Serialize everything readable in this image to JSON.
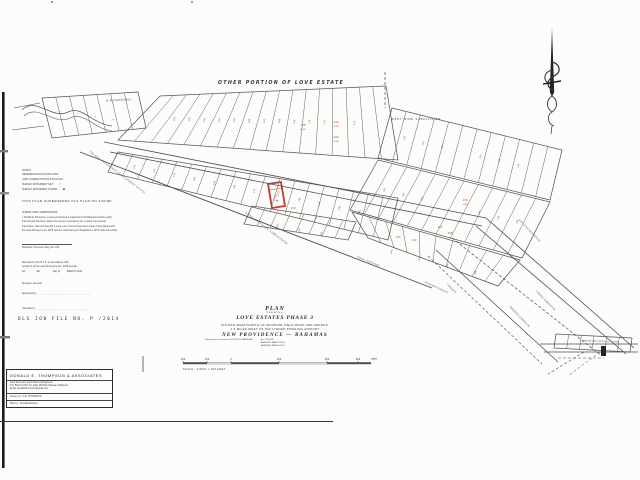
{
  "notes": {
    "title": "NOTES",
    "line1": "REFERENCE DLS PLANS NOS.",
    "line2": "GRID CONNECTION DLS PLAN NO.",
    "line3": "SURVEY MONUMENT SET",
    "line4": "SURVEY MONUMENT FOUND",
    "symbol_set": "○",
    "symbol_found": "■",
    "supersedes": "THIS PLAN SUPERSEDES DLS PLAN NO.532/NP"
  },
  "certificate": {
    "title": "SURVEYOR'S CERTIFICATE",
    "body": [
      "I, Donald E. Thompson, a surveyor licensed & registered in the Bahamas hereby certify",
      "that this plan has been made from surveys executed by me or under my personal",
      "supervision, that both the plan & survey are correct & have been made in accordance with",
      "the Land Surveyor's Act, 1975, and the Land Surveyor's Regulations, 1975 made thereunder."
    ],
    "signature": "Donald E. Thompson  Reg. No. 035"
  },
  "recorded": {
    "line1": "Recorded in the D.L.S. in accordance with",
    "line2": "section 6 of the Land Surveyors Act, 1975 as plan",
    "no": "No.",
    "day": "9th",
    "of": "Day of",
    "date": "MARCH 2014"
  },
  "admin": {
    "surveyor_general": "Surveyor General",
    "approved": "Approved by",
    "checked": "Checked by",
    "dots": "_ _ _ _ _ _ _ _ _ _ _ _ _ _ _",
    "dls_job": "DLS JOB FILE NO. P  /2014"
  },
  "title_block": {
    "plan": "PLAN",
    "shewing": "SHEWING",
    "name": "LOVE ESTATES PHASE 3",
    "situate1": "SITUATE WEST/NORTH OF WINDSOR FIELD ROAD AND APPROX.",
    "situate2": "1.5 MILES WEST OF SIR LYNDEN PINDLING AIRPORT",
    "location": "NEW PROVIDENCE  —  BAHAMAS",
    "instance": "Surveyed at the instance of DOTSON & MARSHALL",
    "acc": "Acc: 236,398",
    "amended1": "AMENDED MARCH 2014",
    "amended2": "AMENDED MARCH 2014"
  },
  "scale_bar": {
    "ticks": [
      {
        "t": "200",
        "x": 183
      },
      {
        "t": "100",
        "x": 207
      },
      {
        "t": "0",
        "x": 231
      },
      {
        "t": "200",
        "x": 279
      },
      {
        "t": "400",
        "x": 327
      },
      {
        "t": "600",
        "x": 358
      }
    ],
    "feet": "FEET",
    "feet_x": 374,
    "label": "SCALE : 1INCH = 200 FEET"
  },
  "firm_box": {
    "name": "DONALD E. THOMPSON & ASSOCIATES",
    "line1": "Land Surveyors-Land Planners-Engineers",
    "line2": "P.O. BOX N-1817  Tel. (242) 356-5014  Nassau, Bahamas",
    "line3": "Email: donaldethompson@gmail.com",
    "survey_by": "Survey by : D.E. THOMPSON",
    "plan_by": "Plan by : Kendall Mortimer"
  },
  "plan": {
    "red_color": "#bf3a32",
    "ink_color": "#454545",
    "svg_labels": [
      {
        "t": "OTHER PORTION OF LOVE ESTATE",
        "x": 281,
        "y": 84,
        "s": 4.8,
        "c": "#3a3a3a",
        "f": "si",
        "ls": 1.3,
        "n": "other-portion-label"
      },
      {
        "t": "WEST WIND SUBDIVISION",
        "x": 416,
        "y": 120,
        "s": 2.9,
        "c": "#4a4a4a",
        "ls": 0.6,
        "n": "west-wind-label"
      },
      {
        "t": "H.B.HANCHELL",
        "x": 119,
        "y": 101,
        "r": -3,
        "s": 2.9,
        "c": "#4a4a4a",
        "ls": 0.4,
        "n": "hanchell-label"
      },
      {
        "t": "THE NEW PROVIDENCE DEVELOPMENT CO.LTD.",
        "x": 117,
        "y": 173,
        "r": 37,
        "s": 2.5,
        "c": "#565656",
        "ls": 0.3,
        "n": "npd-boundary-label"
      },
      {
        "t": "CHARLOTTEVILLE SUBDIVISION",
        "x": 266,
        "y": 229,
        "r": 37,
        "s": 2.7,
        "c": "#565656",
        "ls": 0.4,
        "n": "charlotteville-label"
      },
      {
        "t": "60FT. ROAD RESERVATION",
        "x": 529,
        "y": 231,
        "r": 46,
        "s": 2.3,
        "c": "#636363",
        "n": "road-reservation-label"
      },
      {
        "t": "FOXDALE SUBDIVISION",
        "x": 545,
        "y": 301,
        "r": 46,
        "s": 2.3,
        "c": "#636363",
        "n": "foxdale-label"
      },
      {
        "t": "PINERIDGE SUBDIVISION",
        "x": 519,
        "y": 317,
        "r": 46,
        "s": 2.3,
        "c": "#636363",
        "n": "pineridge-label"
      },
      {
        "t": "TURNBERRY",
        "x": 451,
        "y": 289,
        "r": 46,
        "s": 2.1,
        "c": "#6a6a6a",
        "n": "turnberry-label"
      },
      {
        "t": "FOXHILL SUBDIVISION",
        "x": 368,
        "y": 262,
        "r": 22,
        "s": 2.2,
        "c": "#636363",
        "n": "foxhill-label"
      },
      {
        "t": "PERMANENT TERRACES",
        "x": 436,
        "y": 288,
        "r": 25,
        "s": 2.2,
        "c": "#636363",
        "n": "terraces-label"
      },
      {
        "t": "WINDSOR FIELD ROAD (60FT. WIDE)",
        "x": 600,
        "y": 342,
        "r": 2,
        "s": 2.1,
        "c": "#565656",
        "n": "windsor-field-road-label"
      },
      {
        "t": "173",
        "x": 279,
        "y": 194,
        "r": -80,
        "s": 2.9,
        "c": "#bf3a32",
        "n": "red-lot-number"
      },
      {
        "t": "9,583",
        "x": 275.5,
        "y": 198,
        "r": -80,
        "s": 2,
        "c": "#bf3a32",
        "n": "red-lot-area"
      },
      {
        "t": "118",
        "x": 303,
        "y": 126,
        "s": 2.8,
        "c": "#bf3a32",
        "n": "red-lot-number"
      },
      {
        "t": "5,000",
        "x": 303,
        "y": 130,
        "s": 1.9,
        "c": "#bf3a32",
        "n": "red-lot-area"
      },
      {
        "t": "119",
        "x": 336,
        "y": 123,
        "s": 2.8,
        "c": "#bf3a32",
        "n": "red-lot-number"
      },
      {
        "t": "5,000",
        "x": 336,
        "y": 127,
        "s": 1.9,
        "c": "#bf3a32",
        "n": "red-lot-area"
      },
      {
        "t": "120",
        "x": 336,
        "y": 138,
        "s": 2.8,
        "c": "#bf3a32",
        "n": "red-lot-number"
      },
      {
        "t": "5,000",
        "x": 336,
        "y": 142,
        "s": 1.9,
        "c": "#bf3a32",
        "n": "red-lot-area"
      },
      {
        "t": "139",
        "x": 293,
        "y": 209,
        "s": 2.6,
        "c": "#bf3a32",
        "n": "red-lot-number"
      },
      {
        "t": "143",
        "x": 398,
        "y": 238,
        "s": 2.6,
        "c": "#bf3a32",
        "n": "red-lot-number"
      },
      {
        "t": "144",
        "x": 414,
        "y": 241,
        "s": 2.6,
        "c": "#bf3a32",
        "n": "red-lot-number"
      },
      {
        "t": "156",
        "x": 465,
        "y": 201,
        "s": 2.8,
        "c": "#bf3a32",
        "n": "red-lot-number"
      },
      {
        "t": "5,000",
        "x": 465,
        "y": 205,
        "s": 1.9,
        "c": "#bf3a32",
        "n": "red-lot-area"
      },
      {
        "t": "157",
        "x": 440,
        "y": 228,
        "s": 2.8,
        "c": "#bf3a32",
        "n": "red-lot-number"
      },
      {
        "t": "158",
        "x": 450,
        "y": 234,
        "s": 2.8,
        "c": "#bf3a32",
        "n": "red-lot-number"
      },
      {
        "t": "101",
        "x": 175,
        "y": 119,
        "r": -80,
        "s": 2.1
      },
      {
        "t": "102",
        "x": 190,
        "y": 119,
        "r": -80,
        "s": 2.1
      },
      {
        "t": "103",
        "x": 205,
        "y": 120,
        "r": -80,
        "s": 2.1
      },
      {
        "t": "104",
        "x": 220,
        "y": 120,
        "r": -80,
        "s": 2.1
      },
      {
        "t": "105",
        "x": 235,
        "y": 120,
        "r": -80,
        "s": 2.1
      },
      {
        "t": "106",
        "x": 250,
        "y": 121,
        "r": -80,
        "s": 2.1
      },
      {
        "t": "107",
        "x": 265,
        "y": 121,
        "r": -80,
        "s": 2.1
      },
      {
        "t": "108",
        "x": 280,
        "y": 121,
        "r": -80,
        "s": 2.1
      },
      {
        "t": "109",
        "x": 295,
        "y": 122,
        "r": -80,
        "s": 2.1
      },
      {
        "t": "110",
        "x": 310,
        "y": 122,
        "r": -80,
        "s": 2.1
      },
      {
        "t": "111",
        "x": 325,
        "y": 122,
        "r": -80,
        "s": 2.1
      },
      {
        "t": "112",
        "x": 355,
        "y": 123,
        "r": -80,
        "s": 2.1
      },
      {
        "t": "121",
        "x": 405,
        "y": 138,
        "r": -75,
        "s": 2.1
      },
      {
        "t": "122",
        "x": 424,
        "y": 143,
        "r": -75,
        "s": 2.1
      },
      {
        "t": "123",
        "x": 443,
        "y": 147,
        "r": -75,
        "s": 2.1
      },
      {
        "t": "124",
        "x": 481,
        "y": 157,
        "r": -75,
        "s": 2.1
      },
      {
        "t": "125",
        "x": 500,
        "y": 161,
        "r": -75,
        "s": 2.1
      },
      {
        "t": "126",
        "x": 519,
        "y": 166,
        "r": -75,
        "s": 2.1
      },
      {
        "t": "131",
        "x": 385,
        "y": 190,
        "r": -75,
        "s": 2.1
      },
      {
        "t": "132",
        "x": 404,
        "y": 195,
        "r": -75,
        "s": 2.1
      },
      {
        "t": "133",
        "x": 423,
        "y": 199,
        "r": -75,
        "s": 2.1
      },
      {
        "t": "134",
        "x": 480,
        "y": 213,
        "r": -75,
        "s": 2.1
      },
      {
        "t": "135",
        "x": 499,
        "y": 218,
        "r": -75,
        "s": 2.1
      },
      {
        "t": "136",
        "x": 518,
        "y": 222,
        "r": -75,
        "s": 2.1
      },
      {
        "t": "141",
        "x": 135,
        "y": 167,
        "r": -78,
        "s": 2.1
      },
      {
        "t": "142",
        "x": 155,
        "y": 171,
        "r": -78,
        "s": 2.1
      },
      {
        "t": "143",
        "x": 175,
        "y": 175,
        "r": -78,
        "s": 2.1
      },
      {
        "t": "144",
        "x": 195,
        "y": 179,
        "r": -78,
        "s": 2.1
      },
      {
        "t": "145",
        "x": 215,
        "y": 183,
        "r": -78,
        "s": 2.1
      },
      {
        "t": "146",
        "x": 235,
        "y": 187,
        "r": -78,
        "s": 2.1
      },
      {
        "t": "147",
        "x": 255,
        "y": 191,
        "r": -78,
        "s": 2.1
      },
      {
        "t": "148",
        "x": 300,
        "y": 200,
        "r": -78,
        "s": 2.1
      },
      {
        "t": "149",
        "x": 320,
        "y": 204,
        "r": -78,
        "s": 2.1
      },
      {
        "t": "150",
        "x": 340,
        "y": 208,
        "r": -78,
        "s": 2.1
      },
      {
        "t": "151",
        "x": 360,
        "y": 212,
        "r": -78,
        "s": 2.1
      },
      {
        "t": "1",
        "x": 60,
        "y": 112,
        "r": -75,
        "s": 2.1
      },
      {
        "t": "2",
        "x": 78,
        "y": 114,
        "r": -75,
        "s": 2.1
      },
      {
        "t": "3",
        "x": 96,
        "y": 117,
        "r": -75,
        "s": 2.1
      },
      {
        "t": "4",
        "x": 114,
        "y": 120,
        "r": -75,
        "s": 2.1
      },
      {
        "t": "161",
        "x": 278,
        "y": 226,
        "r": -75,
        "s": 2.1
      },
      {
        "t": "162",
        "x": 300,
        "y": 230,
        "r": -75,
        "s": 2.1
      },
      {
        "t": "163",
        "x": 322,
        "y": 234,
        "r": -75,
        "s": 2.1
      },
      {
        "t": "165",
        "x": 392,
        "y": 252,
        "r": -70,
        "s": 2.1
      },
      {
        "t": "166",
        "x": 420,
        "y": 259,
        "r": -70,
        "s": 2.1
      },
      {
        "t": "167",
        "x": 448,
        "y": 266,
        "r": -70,
        "s": 2.1
      },
      {
        "t": "168",
        "x": 476,
        "y": 273,
        "r": -70,
        "s": 2.1
      }
    ]
  }
}
